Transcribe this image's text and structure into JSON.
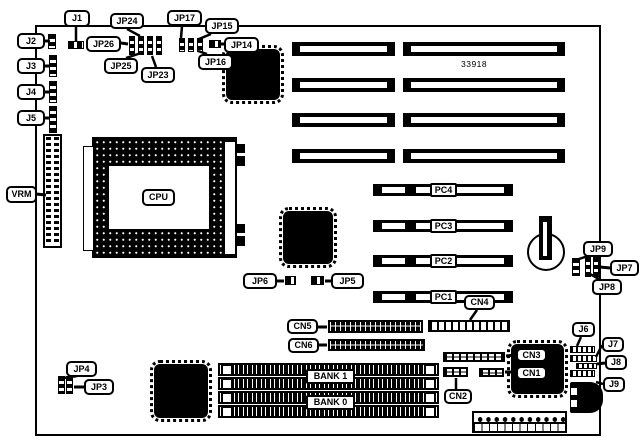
{
  "part_number": "33918",
  "colors": {
    "ink": "#000000",
    "paper": "#ffffff"
  },
  "labels": {
    "j1": "J1",
    "j2": "J2",
    "j3": "J3",
    "j4": "J4",
    "j5": "J5",
    "j6": "J6",
    "j7": "J7",
    "j8": "J8",
    "j9": "J9",
    "jp3": "JP3",
    "jp4": "JP4",
    "jp5": "JP5",
    "jp6": "JP6",
    "jp7": "JP7",
    "jp8": "JP8",
    "jp9": "JP9",
    "jp14": "JP14",
    "jp15": "JP15",
    "jp16": "JP16",
    "jp17": "JP17",
    "jp23": "JP23",
    "jp24": "JP24",
    "jp25": "JP25",
    "jp26": "JP26",
    "vrm": "VRM",
    "cpu": "CPU",
    "pc1": "PC1",
    "pc2": "PC2",
    "pc3": "PC3",
    "pc4": "PC4",
    "cn1": "CN1",
    "cn2": "CN2",
    "cn3": "CN3",
    "cn4": "CN4",
    "cn5": "CN5",
    "cn6": "CN6",
    "bank0": "BANK 0",
    "bank1": "BANK 1"
  }
}
